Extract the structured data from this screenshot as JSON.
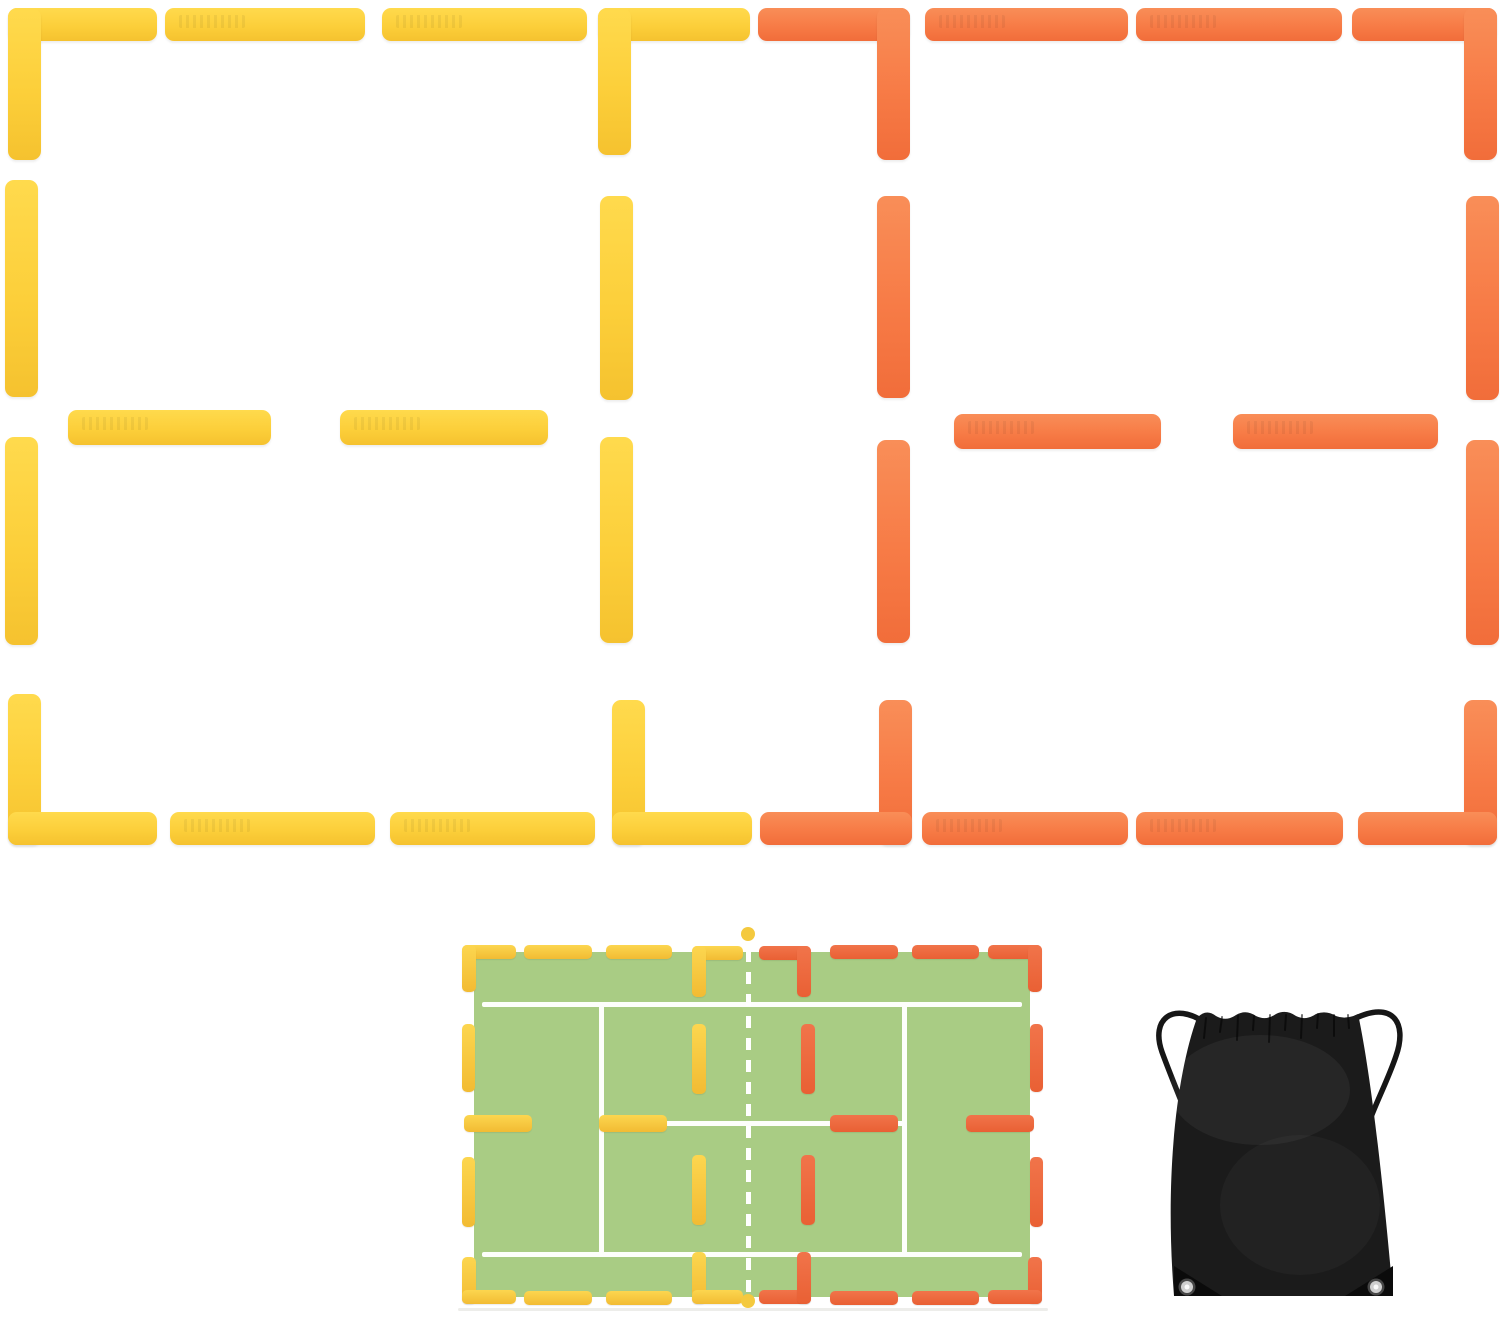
{
  "meta": {
    "description": "Product image: pickleball/tennis court line marker set in yellow and orange, layout diagram on green court, and black drawstring carry bag",
    "canvas": {
      "w": 1500,
      "h": 1318,
      "background": "#ffffff"
    }
  },
  "colors": {
    "marker_yellow": "#fccf3a",
    "marker_orange": "#f77b46",
    "court_green": "#a9cc84",
    "court_line_white": "#fdfefb",
    "dot_yellow": "#f4c93e",
    "bag_black": "#1b1b1b"
  },
  "top_arrangement": {
    "pieces": [
      {
        "n": "yellow-corner-tl-arm-h",
        "x": 8,
        "y": 8,
        "w": 149,
        "h": 33,
        "c": "Y"
      },
      {
        "n": "yellow-corner-tl-arm-v",
        "x": 8,
        "y": 8,
        "w": 33,
        "h": 152,
        "c": "Y"
      },
      {
        "n": "yellow-top-strip-1",
        "x": 165,
        "y": 8,
        "w": 200,
        "h": 33,
        "c": "Y",
        "cls": "em"
      },
      {
        "n": "yellow-top-strip-2",
        "x": 382,
        "y": 8,
        "w": 205,
        "h": 33,
        "c": "Y",
        "cls": "em"
      },
      {
        "n": "yellow-corner-tr-arm-h",
        "x": 598,
        "y": 8,
        "w": 152,
        "h": 33,
        "c": "Y"
      },
      {
        "n": "yellow-corner-tr-arm-v",
        "x": 598,
        "y": 8,
        "w": 33,
        "h": 147,
        "c": "Y"
      },
      {
        "n": "yellow-left-strip-upper",
        "x": 5,
        "y": 180,
        "w": 33,
        "h": 217,
        "c": "Y"
      },
      {
        "n": "yellow-left-strip-lower",
        "x": 5,
        "y": 437,
        "w": 33,
        "h": 208,
        "c": "Y"
      },
      {
        "n": "yellow-right-strip-upper",
        "x": 600,
        "y": 196,
        "w": 33,
        "h": 204,
        "c": "Y"
      },
      {
        "n": "yellow-right-strip-lower",
        "x": 600,
        "y": 437,
        "w": 33,
        "h": 206,
        "c": "Y"
      },
      {
        "n": "yellow-mid-strip-1",
        "x": 68,
        "y": 410,
        "w": 203,
        "h": 35,
        "c": "Y",
        "cls": "em"
      },
      {
        "n": "yellow-mid-strip-2",
        "x": 340,
        "y": 410,
        "w": 208,
        "h": 35,
        "c": "Y",
        "cls": "em"
      },
      {
        "n": "yellow-corner-bl-arm-v",
        "x": 8,
        "y": 694,
        "w": 33,
        "h": 151,
        "c": "Y"
      },
      {
        "n": "yellow-corner-bl-arm-h",
        "x": 8,
        "y": 812,
        "w": 149,
        "h": 33,
        "c": "Y"
      },
      {
        "n": "yellow-bottom-strip-1",
        "x": 170,
        "y": 812,
        "w": 205,
        "h": 33,
        "c": "Y",
        "cls": "em"
      },
      {
        "n": "yellow-bottom-strip-2",
        "x": 390,
        "y": 812,
        "w": 205,
        "h": 33,
        "c": "Y",
        "cls": "em"
      },
      {
        "n": "yellow-corner-br-arm-v",
        "x": 612,
        "y": 700,
        "w": 33,
        "h": 145,
        "c": "Y"
      },
      {
        "n": "yellow-corner-br-arm-h",
        "x": 612,
        "y": 812,
        "w": 140,
        "h": 33,
        "c": "Y"
      },
      {
        "n": "orange-corner-tl-arm-h",
        "x": 758,
        "y": 8,
        "w": 152,
        "h": 33,
        "c": "O"
      },
      {
        "n": "orange-corner-tl-arm-v",
        "x": 877,
        "y": 8,
        "w": 33,
        "h": 152,
        "c": "O"
      },
      {
        "n": "orange-top-strip-1",
        "x": 925,
        "y": 8,
        "w": 203,
        "h": 33,
        "c": "O",
        "cls": "em"
      },
      {
        "n": "orange-top-strip-2",
        "x": 1136,
        "y": 8,
        "w": 206,
        "h": 33,
        "c": "O",
        "cls": "em"
      },
      {
        "n": "orange-corner-tr-arm-h",
        "x": 1352,
        "y": 8,
        "w": 145,
        "h": 33,
        "c": "O"
      },
      {
        "n": "orange-corner-tr-arm-v",
        "x": 1464,
        "y": 8,
        "w": 33,
        "h": 152,
        "c": "O"
      },
      {
        "n": "orange-left-strip-upper",
        "x": 877,
        "y": 196,
        "w": 33,
        "h": 202,
        "c": "O"
      },
      {
        "n": "orange-left-strip-lower",
        "x": 877,
        "y": 440,
        "w": 33,
        "h": 203,
        "c": "O"
      },
      {
        "n": "orange-right-strip-upper",
        "x": 1466,
        "y": 196,
        "w": 33,
        "h": 204,
        "c": "O"
      },
      {
        "n": "orange-right-strip-lower",
        "x": 1466,
        "y": 440,
        "w": 33,
        "h": 205,
        "c": "O"
      },
      {
        "n": "orange-mid-strip-1",
        "x": 954,
        "y": 414,
        "w": 207,
        "h": 35,
        "c": "O",
        "cls": "em"
      },
      {
        "n": "orange-mid-strip-2",
        "x": 1233,
        "y": 414,
        "w": 205,
        "h": 35,
        "c": "O",
        "cls": "em"
      },
      {
        "n": "orange-corner-bl-arm-v",
        "x": 879,
        "y": 700,
        "w": 33,
        "h": 145,
        "c": "O"
      },
      {
        "n": "orange-corner-bl-arm-h",
        "x": 760,
        "y": 812,
        "w": 152,
        "h": 33,
        "c": "O"
      },
      {
        "n": "orange-bottom-strip-1",
        "x": 922,
        "y": 812,
        "w": 206,
        "h": 33,
        "c": "O",
        "cls": "em"
      },
      {
        "n": "orange-bottom-strip-2",
        "x": 1136,
        "y": 812,
        "w": 207,
        "h": 33,
        "c": "O",
        "cls": "em"
      },
      {
        "n": "orange-corner-br-arm-v",
        "x": 1464,
        "y": 700,
        "w": 33,
        "h": 145,
        "c": "O"
      },
      {
        "n": "orange-corner-br-arm-h",
        "x": 1358,
        "y": 812,
        "w": 139,
        "h": 33,
        "c": "O"
      }
    ]
  },
  "court_diagram": {
    "pieces": [
      {
        "n": "court-surface",
        "x": 474,
        "y": 952,
        "w": 556,
        "h": 345,
        "c": "G"
      },
      {
        "n": "court-line-top",
        "x": 482,
        "y": 1002,
        "w": 540,
        "h": 5,
        "c": "W"
      },
      {
        "n": "court-line-bottom",
        "x": 482,
        "y": 1252,
        "w": 540,
        "h": 5,
        "c": "W"
      },
      {
        "n": "court-line-left-vertical",
        "x": 599,
        "y": 1002,
        "w": 5,
        "h": 255,
        "c": "W"
      },
      {
        "n": "court-line-right-vertical",
        "x": 902,
        "y": 1002,
        "w": 5,
        "h": 255,
        "c": "W"
      },
      {
        "n": "court-line-center",
        "x": 599,
        "y": 1121,
        "w": 308,
        "h": 5,
        "c": "W"
      },
      {
        "n": "court-ground-shadow",
        "x": 458,
        "y": 1308,
        "w": 590,
        "h": 3,
        "c": "SH"
      },
      {
        "n": "court-net-dashed-line",
        "x": 746,
        "y": 950,
        "w": 5,
        "h": 344,
        "c": "dashV"
      },
      {
        "n": "court-yellow-corner-tl-h",
        "x": 462,
        "y": 945,
        "w": 54,
        "h": 14,
        "c": "CY"
      },
      {
        "n": "court-yellow-corner-tl-v",
        "x": 462,
        "y": 945,
        "w": 14,
        "h": 47,
        "c": "CY"
      },
      {
        "n": "court-yellow-top-dash-1",
        "x": 524,
        "y": 945,
        "w": 68,
        "h": 14,
        "c": "CY"
      },
      {
        "n": "court-yellow-top-dash-2",
        "x": 606,
        "y": 945,
        "w": 66,
        "h": 14,
        "c": "CY"
      },
      {
        "n": "court-yellow-corner-topcenter-h",
        "x": 692,
        "y": 946,
        "w": 51,
        "h": 14,
        "c": "CY"
      },
      {
        "n": "court-yellow-corner-topcenter-v",
        "x": 692,
        "y": 946,
        "w": 14,
        "h": 51,
        "c": "CY"
      },
      {
        "n": "court-orange-corner-topcenter-h",
        "x": 759,
        "y": 946,
        "w": 52,
        "h": 14,
        "c": "CO"
      },
      {
        "n": "court-orange-corner-topcenter-v",
        "x": 797,
        "y": 946,
        "w": 14,
        "h": 51,
        "c": "CO"
      },
      {
        "n": "court-orange-top-dash-1",
        "x": 830,
        "y": 945,
        "w": 68,
        "h": 14,
        "c": "CO"
      },
      {
        "n": "court-orange-top-dash-2",
        "x": 912,
        "y": 945,
        "w": 67,
        "h": 14,
        "c": "CO"
      },
      {
        "n": "court-orange-corner-tr-h",
        "x": 988,
        "y": 945,
        "w": 54,
        "h": 14,
        "c": "CO"
      },
      {
        "n": "court-orange-corner-tr-v",
        "x": 1028,
        "y": 945,
        "w": 14,
        "h": 47,
        "c": "CO"
      },
      {
        "n": "court-yellow-left-dash-upper",
        "x": 462,
        "y": 1024,
        "w": 13,
        "h": 68,
        "c": "CY"
      },
      {
        "n": "court-yellow-left-dash-lower",
        "x": 462,
        "y": 1157,
        "w": 13,
        "h": 70,
        "c": "CY"
      },
      {
        "n": "court-orange-right-dash-upper",
        "x": 1030,
        "y": 1024,
        "w": 13,
        "h": 68,
        "c": "CO"
      },
      {
        "n": "court-orange-right-dash-lower",
        "x": 1030,
        "y": 1157,
        "w": 13,
        "h": 70,
        "c": "CO"
      },
      {
        "n": "court-yellow-mid-edge-strip",
        "x": 464,
        "y": 1115,
        "w": 68,
        "h": 17,
        "c": "CY"
      },
      {
        "n": "court-yellow-mid-inner-strip",
        "x": 599,
        "y": 1115,
        "w": 68,
        "h": 17,
        "c": "CY"
      },
      {
        "n": "court-orange-mid-inner-strip",
        "x": 830,
        "y": 1115,
        "w": 68,
        "h": 17,
        "c": "CO"
      },
      {
        "n": "court-orange-mid-edge-strip",
        "x": 966,
        "y": 1115,
        "w": 68,
        "h": 17,
        "c": "CO"
      },
      {
        "n": "court-yellow-t-dash-upper",
        "x": 692,
        "y": 1024,
        "w": 14,
        "h": 70,
        "c": "CY"
      },
      {
        "n": "court-yellow-t-dash-lower",
        "x": 692,
        "y": 1155,
        "w": 14,
        "h": 70,
        "c": "CY"
      },
      {
        "n": "court-orange-t-dash-upper",
        "x": 801,
        "y": 1024,
        "w": 14,
        "h": 70,
        "c": "CO"
      },
      {
        "n": "court-orange-t-dash-lower",
        "x": 801,
        "y": 1155,
        "w": 14,
        "h": 70,
        "c": "CO"
      },
      {
        "n": "court-yellow-corner-bl-v",
        "x": 462,
        "y": 1257,
        "w": 14,
        "h": 47,
        "c": "CY"
      },
      {
        "n": "court-yellow-corner-bl-h",
        "x": 462,
        "y": 1290,
        "w": 54,
        "h": 14,
        "c": "CY"
      },
      {
        "n": "court-yellow-bottom-dash-1",
        "x": 524,
        "y": 1291,
        "w": 68,
        "h": 14,
        "c": "CY"
      },
      {
        "n": "court-yellow-bottom-dash-2",
        "x": 606,
        "y": 1291,
        "w": 66,
        "h": 14,
        "c": "CY"
      },
      {
        "n": "court-yellow-corner-bottomcenter-v",
        "x": 692,
        "y": 1252,
        "w": 14,
        "h": 52,
        "c": "CY"
      },
      {
        "n": "court-yellow-corner-bottomcenter-h",
        "x": 692,
        "y": 1290,
        "w": 51,
        "h": 14,
        "c": "CY"
      },
      {
        "n": "court-orange-corner-bottomcenter-h",
        "x": 759,
        "y": 1290,
        "w": 52,
        "h": 14,
        "c": "CO"
      },
      {
        "n": "court-orange-corner-bottomcenter-v",
        "x": 797,
        "y": 1252,
        "w": 14,
        "h": 52,
        "c": "CO"
      },
      {
        "n": "court-orange-bottom-dash-1",
        "x": 830,
        "y": 1291,
        "w": 68,
        "h": 14,
        "c": "CO"
      },
      {
        "n": "court-orange-bottom-dash-2",
        "x": 912,
        "y": 1291,
        "w": 67,
        "h": 14,
        "c": "CO"
      },
      {
        "n": "court-orange-corner-br-v",
        "x": 1028,
        "y": 1257,
        "w": 14,
        "h": 47,
        "c": "CO"
      },
      {
        "n": "court-orange-corner-br-h",
        "x": 988,
        "y": 1290,
        "w": 54,
        "h": 14,
        "c": "CO"
      },
      {
        "n": "court-net-dot-top",
        "x": 741,
        "y": 927,
        "w": 14,
        "h": 14,
        "c": "D"
      },
      {
        "n": "court-net-dot-bottom",
        "x": 741,
        "y": 1294,
        "w": 14,
        "h": 14,
        "c": "D"
      }
    ]
  },
  "bag": {
    "body_color": "#1b1b1b",
    "cord_color": "#161616",
    "tab_color": "#0b0b0b",
    "grommet_outer": "#474747",
    "grommet_ring": "#cfcfcf",
    "grommet_hole": "#fafafa"
  }
}
